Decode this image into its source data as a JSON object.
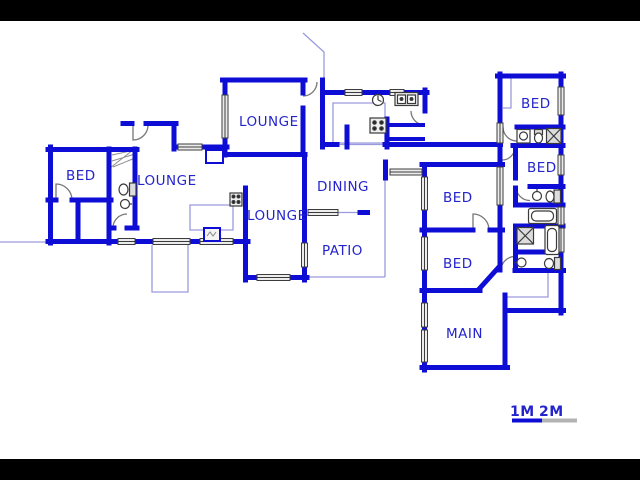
{
  "rooms": [
    {
      "name": "bed-left",
      "label": "BED"
    },
    {
      "name": "lounge-left",
      "label": "LOUNGE"
    },
    {
      "name": "lounge-top",
      "label": "LOUNGE"
    },
    {
      "name": "lounge-center",
      "label": "LOUNGE"
    },
    {
      "name": "dining",
      "label": "DINING"
    },
    {
      "name": "patio",
      "label": "PATIO"
    },
    {
      "name": "bed-center-upper",
      "label": "BED"
    },
    {
      "name": "bed-center-lower",
      "label": "BED"
    },
    {
      "name": "main-bedroom",
      "label": "MAIN"
    },
    {
      "name": "bed-right-upper",
      "label": "BED"
    },
    {
      "name": "bed-right-lower",
      "label": "BED"
    }
  ],
  "scale_bar": {
    "labels": [
      "1M",
      "2M"
    ],
    "segment_colors": [
      "#0d0dd6",
      "#b3b3b3"
    ]
  },
  "colors": {
    "wall": "#0d0dd6",
    "room_label": "#2424cc",
    "light_line": "#9a9ade",
    "window_fill": "#ececec",
    "fixture_outline": "#3a3a3a",
    "letterbox": "#000000",
    "background": "#ffffff"
  },
  "icons": [
    "toilet-icon",
    "basin-icon",
    "shower-icon",
    "bathtub-icon",
    "stove-icon",
    "double-sink-icon",
    "hob-icon",
    "fireplace-icon",
    "cupboard-icon",
    "kitchen-tap-icon",
    "door-arc",
    "window-glyph",
    "stairs-glyph"
  ]
}
